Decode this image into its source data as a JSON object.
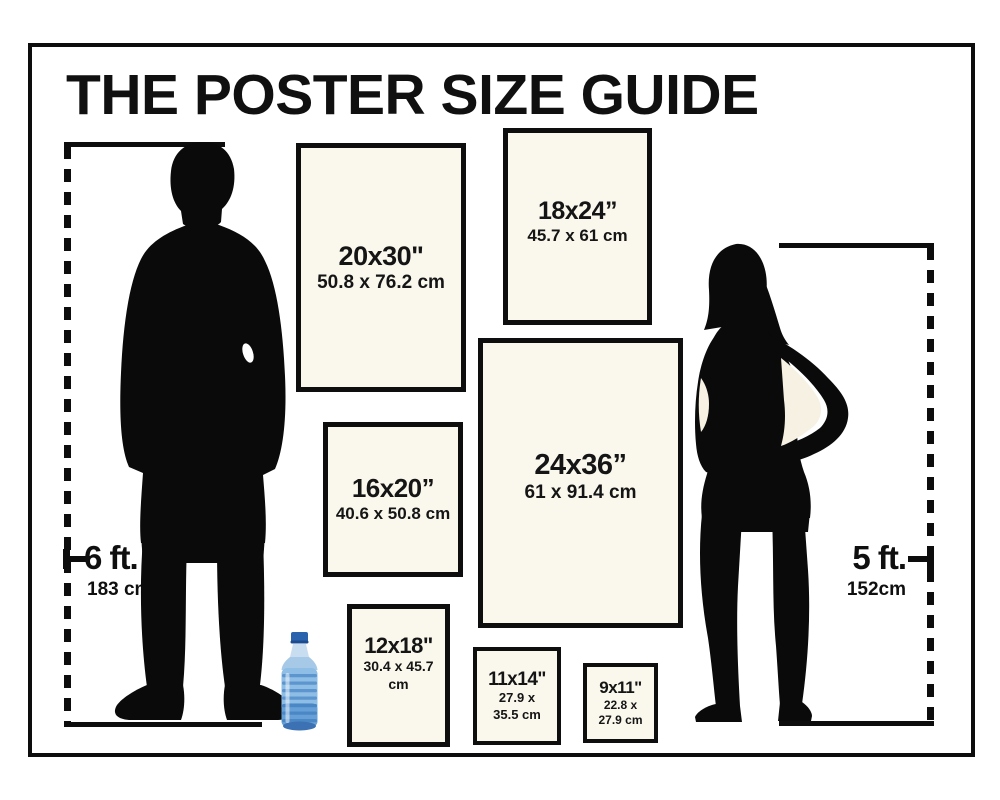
{
  "title": "THE POSTER SIZE GUIDE",
  "posters": [
    {
      "id": "20x30",
      "size": "20x30\"",
      "metric": "50.8 x 76.2 cm"
    },
    {
      "id": "18x24",
      "size": "18x24”",
      "metric": "45.7 x 61 cm"
    },
    {
      "id": "24x36",
      "size": "24x36”",
      "metric": "61 x 91.4 cm"
    },
    {
      "id": "16x20",
      "size": "16x20”",
      "metric": "40.6 x 50.8 cm"
    },
    {
      "id": "12x18",
      "size": "12x18\"",
      "metric": "30.4 x 45.7 cm"
    },
    {
      "id": "11x14",
      "size": "11x14\"",
      "metric_line1": "27.9 x",
      "metric_line2": "35.5 cm"
    },
    {
      "id": "9x11",
      "size": "9x11\"",
      "metric_line1": "22.8 x",
      "metric_line2": "27.9 cm"
    }
  ],
  "scale_references": {
    "man": {
      "height_ft": "6 ft.",
      "height_cm": "183 cm"
    },
    "woman": {
      "height_ft": "5 ft.",
      "height_cm": "152cm"
    }
  },
  "icons": {
    "man": "man-silhouette",
    "woman": "woman-silhouette",
    "bottle": "water-bottle"
  },
  "colors": {
    "ink": "#0d0d0d",
    "poster_fill": "#faf7ec",
    "gap_cream": "#f6f1e2",
    "bottle_blue": "#2a63ad"
  }
}
